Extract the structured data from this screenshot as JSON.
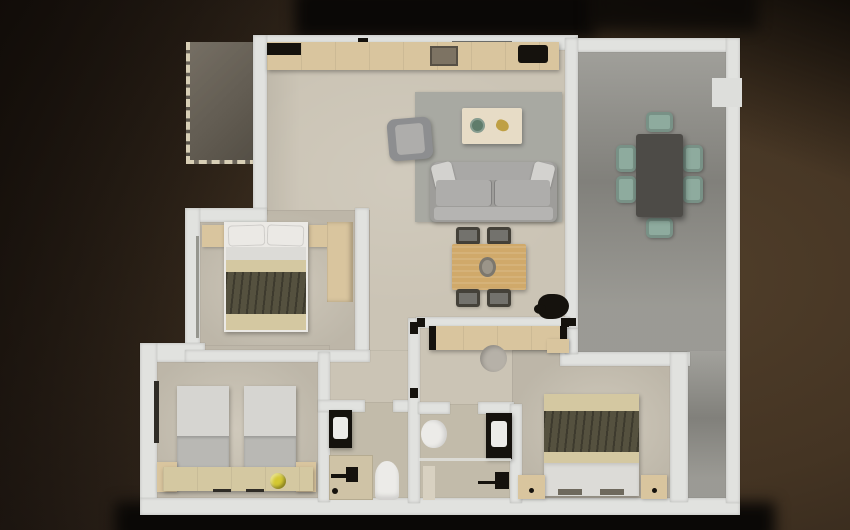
{
  "scene": {
    "type": "3d-floor-plan-render",
    "view": "top-down",
    "canvas_width": 850,
    "canvas_height": 530,
    "rooms": [
      "living-dining-room",
      "kitchen-strip",
      "bedroom-main",
      "bedroom-twin",
      "bedroom-second",
      "bathroom-1",
      "bathroom-2",
      "hallway",
      "terrace",
      "entry-porch"
    ],
    "furniture": [
      "sofa",
      "armchair",
      "coffee-table",
      "area-rug",
      "dining-table-4-chairs",
      "houseplant",
      "sideboard",
      "pouf",
      "kitchen-counter",
      "cooktop",
      "kitchen-sink",
      "double-bed",
      "nightstands",
      "wardrobe",
      "twin-beds",
      "bench-desk",
      "yellow-ball",
      "vanity-sink",
      "toilet",
      "shower",
      "outdoor-table-6-chairs",
      "wall-unit"
    ]
  },
  "colors": {
    "wall": "#e1e2df",
    "floor": "#cbc4b5",
    "floor_dark": "#c2bbaa",
    "porch": "#6b6458",
    "terrace": "#96958f",
    "rug": "#a8a9a2",
    "sofa": "#9e9d9a",
    "sofa_cushion": "#aeadab",
    "sofa_back": "#a9a8a6",
    "sofa_front": "#b5b4b2",
    "armchair": "#8d8e90",
    "pillow": "#d3d2cf",
    "coffee_table": "#e7dcc6",
    "plate_green": "#5f7c6b",
    "decor_gold": "#bfa044",
    "wood": "#d9c59e",
    "table_wood": "#d0a96a",
    "centerpiece": "#9b9589",
    "chair_dark": "#444139",
    "chair_seat": "#73726d",
    "outdoor_table": "#4d4b47",
    "chair_teal": "#8eab9e",
    "linen": "#ebe9e5",
    "sheet": "#dcdbd7",
    "blanket_beige": "#d4c8a1",
    "blanket_olive": "#55513f",
    "twin_light": "#d6d5d1",
    "twin_dark": "#b9b8b4",
    "black": "#15120d",
    "porcelain": "#ecebe8",
    "yellow": "#d4c832",
    "pouf": "#b6b1a8",
    "dark_wood": "#2f2c26",
    "white_box": "#dddedb",
    "sink_bronze": "#7d7363",
    "shower_pan": "#cfc3a6",
    "window_gray": "#96968f",
    "footboard": "#6e695d",
    "mat": "#d8d1c1",
    "shadow_black": "#0a0806",
    "background_brown": "#443423"
  }
}
